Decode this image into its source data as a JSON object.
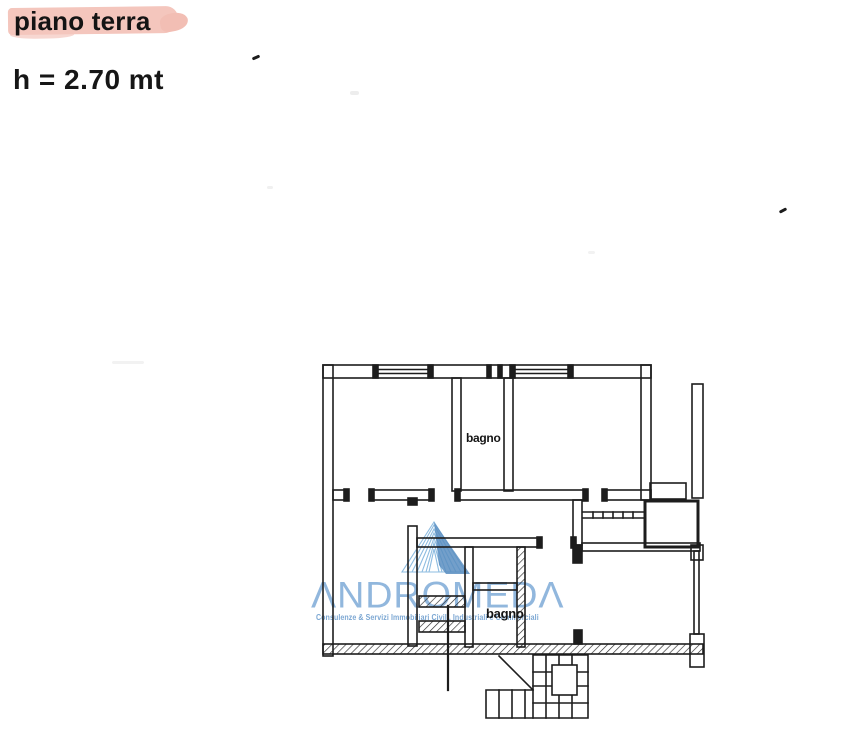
{
  "page": {
    "title": "piano terra",
    "height_note": "h = 2.70 mt"
  },
  "floor_plan": {
    "labels": [
      {
        "text": "bagno"
      },
      {
        "text": "bagno"
      }
    ]
  },
  "watermark": {
    "brand": "ANDROMEDA",
    "brand_stylized": "ΛNDROMEDΛ",
    "tagline": "Consulenze & Servizi Immobiliari Civili, Industriali e Commerciali",
    "colors": {
      "logo_light": "#86b7de",
      "logo_dark": "#4d86bc",
      "text": "#78a6d4"
    }
  },
  "scan": {
    "highlight_color": "#f4c6bd",
    "ink_color": "#1d1d1d",
    "paper_color": "#ffffff"
  }
}
